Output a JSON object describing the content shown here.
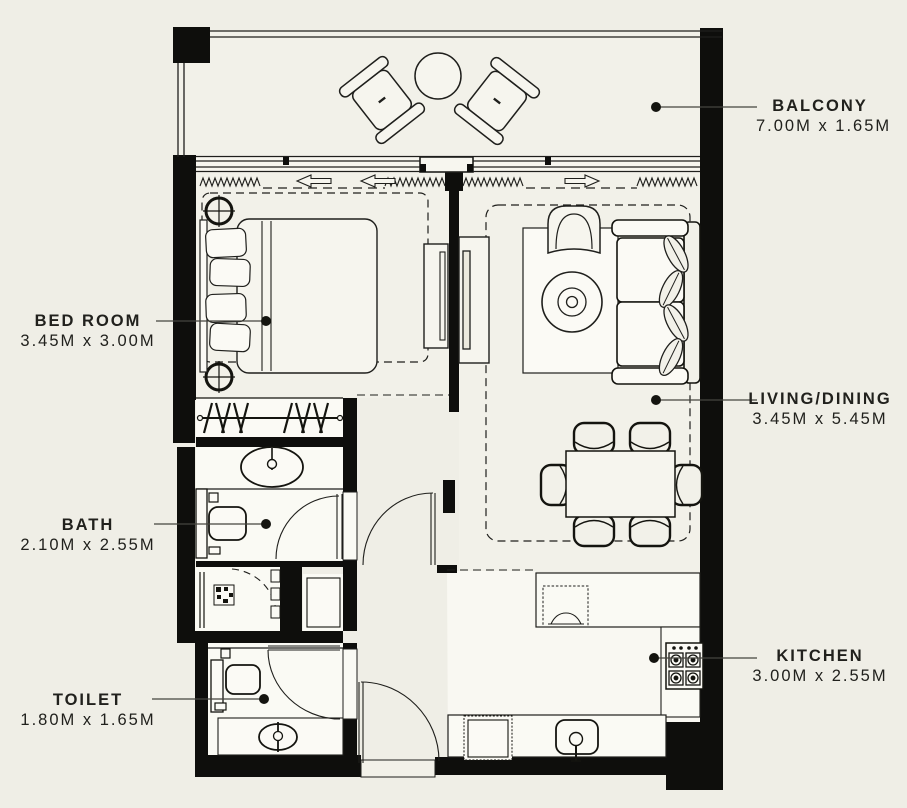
{
  "plan": {
    "type": "apartment-floor-plan",
    "colors": {
      "background": "#efeee6",
      "wall": "#0e0e0c",
      "room_fill": "#f2f1e9",
      "wet_room_fill": "#fafaf4",
      "line": "#1f1f1c",
      "leader": "#45453f",
      "text": "#21211d"
    },
    "rooms": [
      {
        "id": "balcony",
        "name": "BALCONY",
        "dimensions": "7.00M x 1.65M"
      },
      {
        "id": "bedroom",
        "name": "BED ROOM",
        "dimensions": "3.45M x 3.00M"
      },
      {
        "id": "living",
        "name": "LIVING/DINING",
        "dimensions": "3.45M x 5.45M"
      },
      {
        "id": "bath",
        "name": "BATH",
        "dimensions": "2.10M x 2.55M"
      },
      {
        "id": "toilet",
        "name": "TOILET",
        "dimensions": "1.80M x 1.65M"
      },
      {
        "id": "kitchen",
        "name": "KITCHEN",
        "dimensions": "3.00M x 2.55M"
      }
    ]
  }
}
